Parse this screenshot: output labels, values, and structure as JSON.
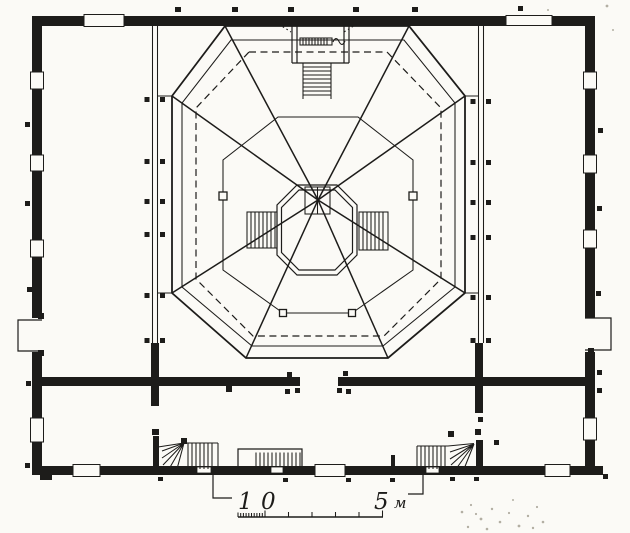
{
  "drawing": {
    "kind": "scanned architectural floor plan, octagonal tent roof over square hall",
    "colors": {
      "ink": "#1d1c1a",
      "paper": "#fbfaf6"
    }
  },
  "scale_bar": {
    "one": "1",
    "zero": "0",
    "five": "5",
    "unit": "м"
  }
}
